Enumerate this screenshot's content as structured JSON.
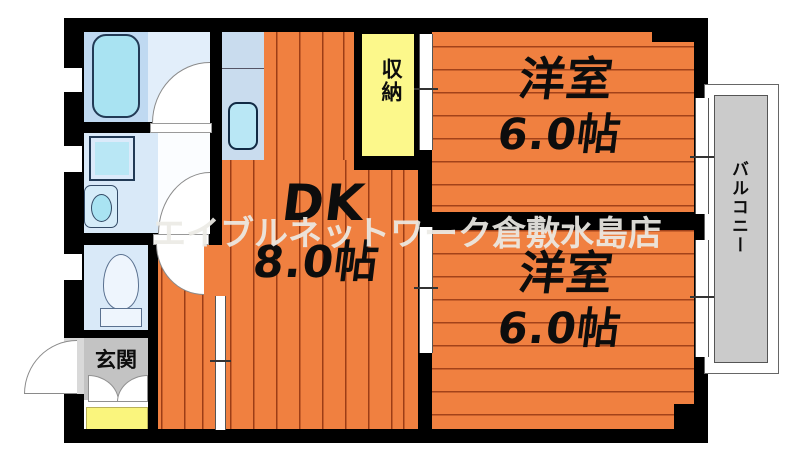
{
  "floorplan": {
    "watermark": "エイブルネットワーク倉敷水島店",
    "rooms": {
      "dk": {
        "name": "DK",
        "size": "8.0帖"
      },
      "bedroom_top": {
        "name": "洋室",
        "size": "6.0帖"
      },
      "bedroom_bottom": {
        "name": "洋室",
        "size": "6.0帖"
      },
      "closet": {
        "label": "収納"
      },
      "entrance": {
        "label": "玄関"
      },
      "balcony": {
        "label": "バルコニー"
      }
    },
    "colors": {
      "floor_orange": "#f08040",
      "plank_line": "#6e1900",
      "wall_black": "#000000",
      "closet_yellow": "#fcf88b",
      "entrance_gray": "#c3c3c3",
      "mat_yellow": "#faf57d",
      "balcony_gray": "#cbcbcb",
      "wet_area_blue": "#d9e9f8",
      "fixture_cyan": "#a9e3f2",
      "watermark_gray": "#ebe9e4"
    },
    "fixtures": [
      "bathtub",
      "washing-machine-pan",
      "washbasin",
      "toilet",
      "kitchen-sink"
    ]
  }
}
